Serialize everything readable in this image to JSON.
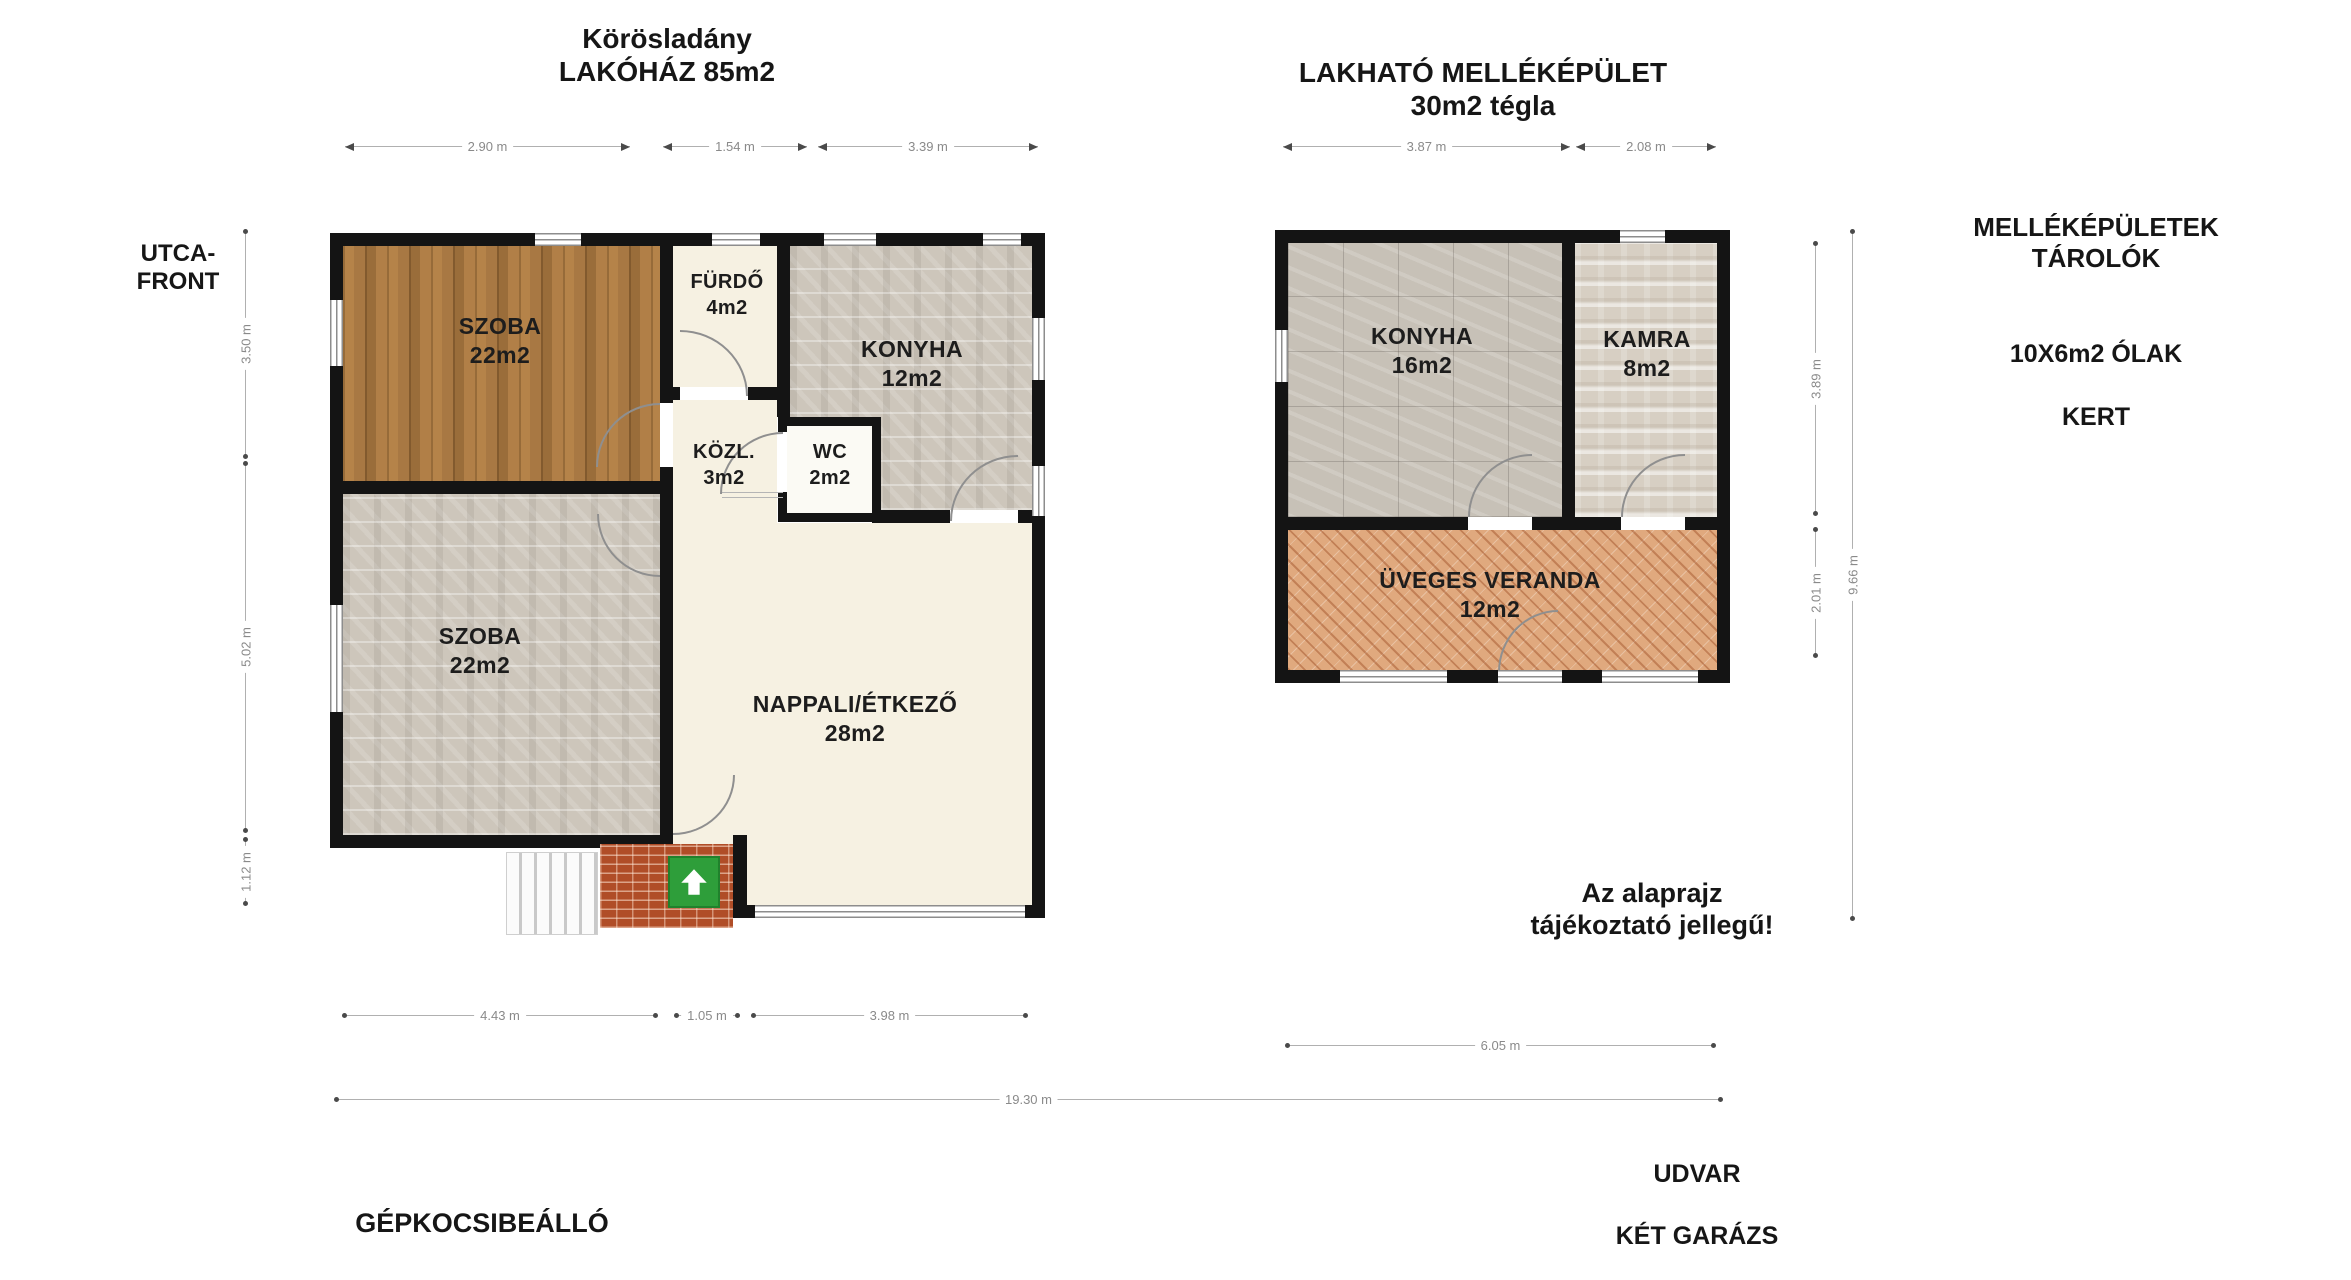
{
  "titles": {
    "main_house": [
      "Körösladány",
      "LAKÓHÁZ 85m2"
    ],
    "outbuilding": [
      "LAKHATÓ MELLÉKÉPÜLET",
      "30m2 tégla"
    ]
  },
  "labels": {
    "street_front": [
      "UTCA-",
      "FRONT"
    ],
    "outbuildings_storage": [
      "MELLÉKÉPÜLETEK",
      "TÁROLÓK"
    ],
    "sties": "10X6m2 ÓLAK",
    "garden": "KERT",
    "disclaimer": [
      "Az alaprajz",
      "tájékoztató jellegű!"
    ],
    "carport": "GÉPKOCSIBEÁLLÓ",
    "yard": "UDVAR",
    "garages": "KÉT GARÁZS"
  },
  "main_house": {
    "rooms": {
      "szoba_top": {
        "name": "SZOBA",
        "area": "22m2"
      },
      "furdo": {
        "name": "FÜRDŐ",
        "area": "4m2"
      },
      "konyha": {
        "name": "KONYHA",
        "area": "12m2"
      },
      "kozl": {
        "name": "KÖZL.",
        "area": "3m2"
      },
      "wc": {
        "name": "WC",
        "area": "2m2"
      },
      "szoba_bottom": {
        "name": "SZOBA",
        "area": "22m2"
      },
      "nappali": {
        "name": "NAPPALI/ÉTKEZŐ",
        "area": "28m2"
      }
    },
    "dimensions": {
      "top": [
        "2.90 m",
        "1.54 m",
        "3.39 m"
      ],
      "left": [
        "3.50 m",
        "5.02 m",
        "1.12 m"
      ],
      "bottom": [
        "4.43 m",
        "1.05 m",
        "3.98 m"
      ],
      "total_width": "19.30 m"
    }
  },
  "outbuilding": {
    "rooms": {
      "konyha": {
        "name": "KONYHA",
        "area": "16m2"
      },
      "kamra": {
        "name": "KAMRA",
        "area": "8m2"
      },
      "veranda": {
        "name": "ÜVEGES VERANDA",
        "area": "12m2"
      }
    },
    "dimensions": {
      "top": [
        "3.87 m",
        "2.08 m"
      ],
      "right": [
        "3.89 m",
        "2.01 m"
      ],
      "right_total": "9.66 m",
      "bottom": "6.05 m"
    }
  },
  "colors": {
    "wall": "#141414",
    "wood_floor": "#ad7b44",
    "stone_floor": "#cdc6bb",
    "tile_floor": "#c7c1b7",
    "travertine_floor": "#d7cfc3",
    "veranda_floor": "#e0a97e",
    "cream_floor": "#f6f1e2",
    "brick_step": "#b04d27",
    "entrance_green": "#2e9e3a",
    "dimension_line": "#b0b0b0"
  }
}
